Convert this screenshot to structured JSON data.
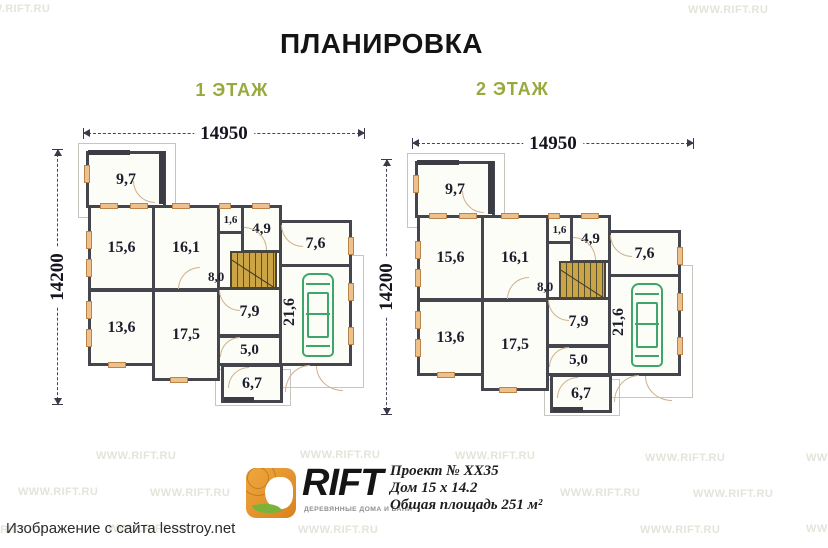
{
  "title": "ПЛАНИРОВКА",
  "source_caption": "Изображение с сайта lesstroy.net",
  "watermark": {
    "text": "WWW.RIFT.RU"
  },
  "logo": {
    "name": "RIFT",
    "tagline": "ДЕРЕВЯННЫЕ ДОМА И БАНИ"
  },
  "project": {
    "number": "Проект № ХХ35",
    "dimensions": "Дом 15 х 14.2",
    "total_area": "Общая площадь 251 м²"
  },
  "floors": [
    {
      "label": "1 ЭТАЖ",
      "width_dim": "14950",
      "height_dim": "14200",
      "rooms": {
        "a97": "9,7",
        "a156": "15,6",
        "a161": "16,1",
        "a16": "1,6",
        "a49": "4,9",
        "a76": "7,6",
        "a216": "21,6",
        "a80": "8,0",
        "a79": "7,9",
        "a136": "13,6",
        "a175": "17,5",
        "a50": "5,0",
        "a67": "6,7"
      }
    },
    {
      "label": "2 ЭТАЖ",
      "width_dim": "14950",
      "height_dim": "14200",
      "rooms": {
        "a97": "9,7",
        "a156": "15,6",
        "a161": "16,1",
        "a16": "1,6",
        "a49": "4,9",
        "a76": "7,6",
        "a216": "21,6",
        "a80": "8,0",
        "a79": "7,9",
        "a136": "13,6",
        "a175": "17,5",
        "a50": "5,0",
        "a67": "6,7"
      }
    }
  ],
  "colors": {
    "floor_label_green": "#9aa93e",
    "stairs_tan": "#caa445",
    "car_green": "#3fa66b",
    "window_orange": "#eec08b",
    "wall": "#45454e",
    "watermark_gray": "#e4e4da",
    "logo_orange": "#e08a2b",
    "leaf_green": "#7ab33a"
  }
}
